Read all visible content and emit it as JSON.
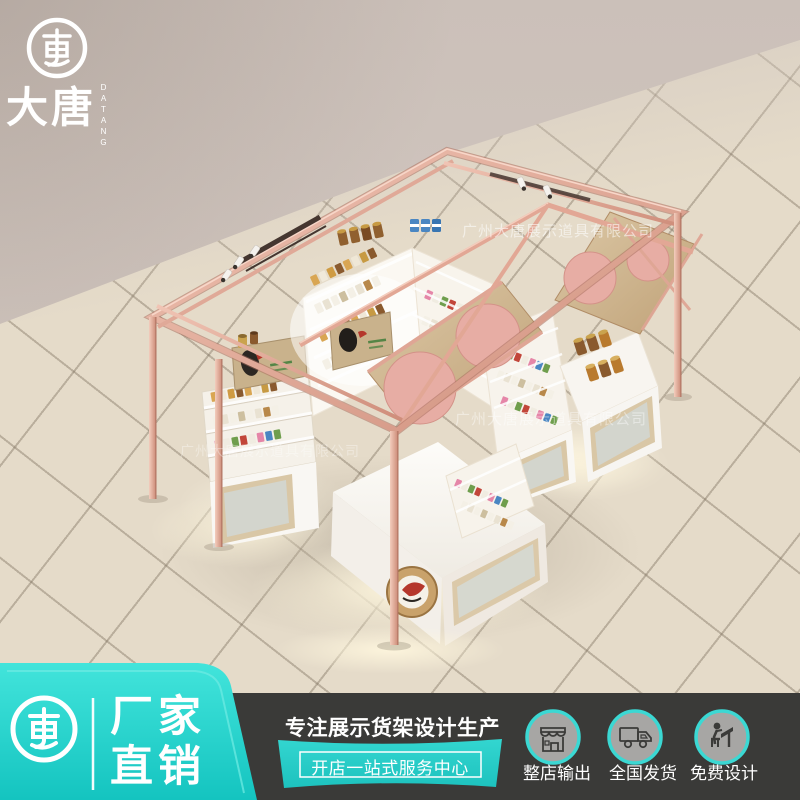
{
  "brand": {
    "name_cn": "大唐",
    "name_en": "DATANG",
    "emblem": "datang-coin-logo"
  },
  "watermark": {
    "text": "广州大唐展示道具有限公司"
  },
  "bottom_bar": {
    "left_badge": {
      "line1": "厂家",
      "line2": "直销"
    },
    "slogan_main": "专注展示货架设计生产",
    "slogan_sub": "开店一站式服务中心",
    "features": [
      {
        "icon": "storefront-icon",
        "label": "整店输出"
      },
      {
        "icon": "truck-icon",
        "label": "全国发货"
      },
      {
        "icon": "designer-icon",
        "label": "免费设计"
      }
    ]
  },
  "colors": {
    "teal": "#2bd6cf",
    "teal_dark": "#14c4c0",
    "dark_bar": "#3a3a38",
    "wall": "#cfc4bd",
    "floor": "#e5dbc9",
    "rose_gold": "#dfa495",
    "wood": "#d5c2a0",
    "gable_circle_pink": "#e7ada4"
  }
}
